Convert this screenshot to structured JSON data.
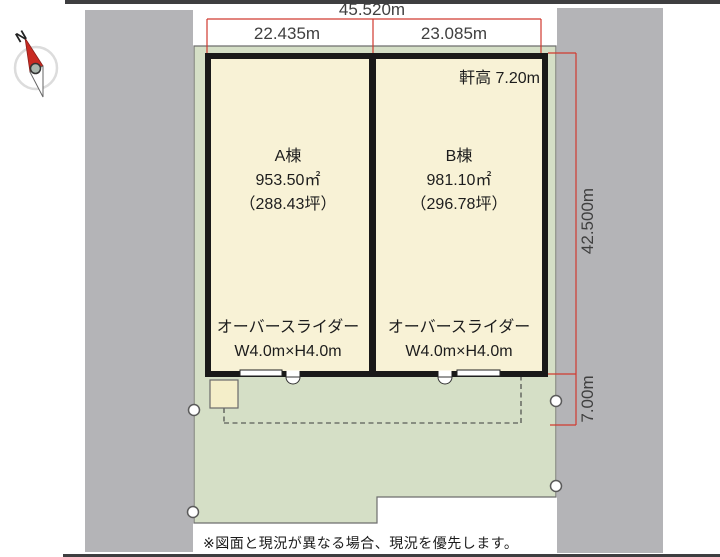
{
  "colors": {
    "site_green": "#d5dfc6",
    "building_cream": "#f8f2d6",
    "adjacent_parcel_gray": "#b4b4b7",
    "dimension_red": "#d03a30",
    "wall_black": "#191919"
  },
  "compass": {
    "north_label": "N"
  },
  "dimensions": {
    "top_total": "45.520m",
    "top_a": "22.435m",
    "top_b": "23.085m",
    "right_depth": "42.500m",
    "right_front": "7.00m",
    "eave_height": "軒高 7.20m"
  },
  "buildings": {
    "a": {
      "name": "A棟",
      "area_m2": "953.50㎡",
      "area_tsubo": "（288.43坪）",
      "door_type": "オーバースライダー",
      "door_size": "W4.0m×H4.0m"
    },
    "b": {
      "name": "B棟",
      "area_m2": "981.10㎡",
      "area_tsubo": "（296.78坪）",
      "door_type": "オーバースライダー",
      "door_size": "W4.0m×H4.0m"
    }
  },
  "note": "※図面と現況が異なる場合、現況を優先します。"
}
